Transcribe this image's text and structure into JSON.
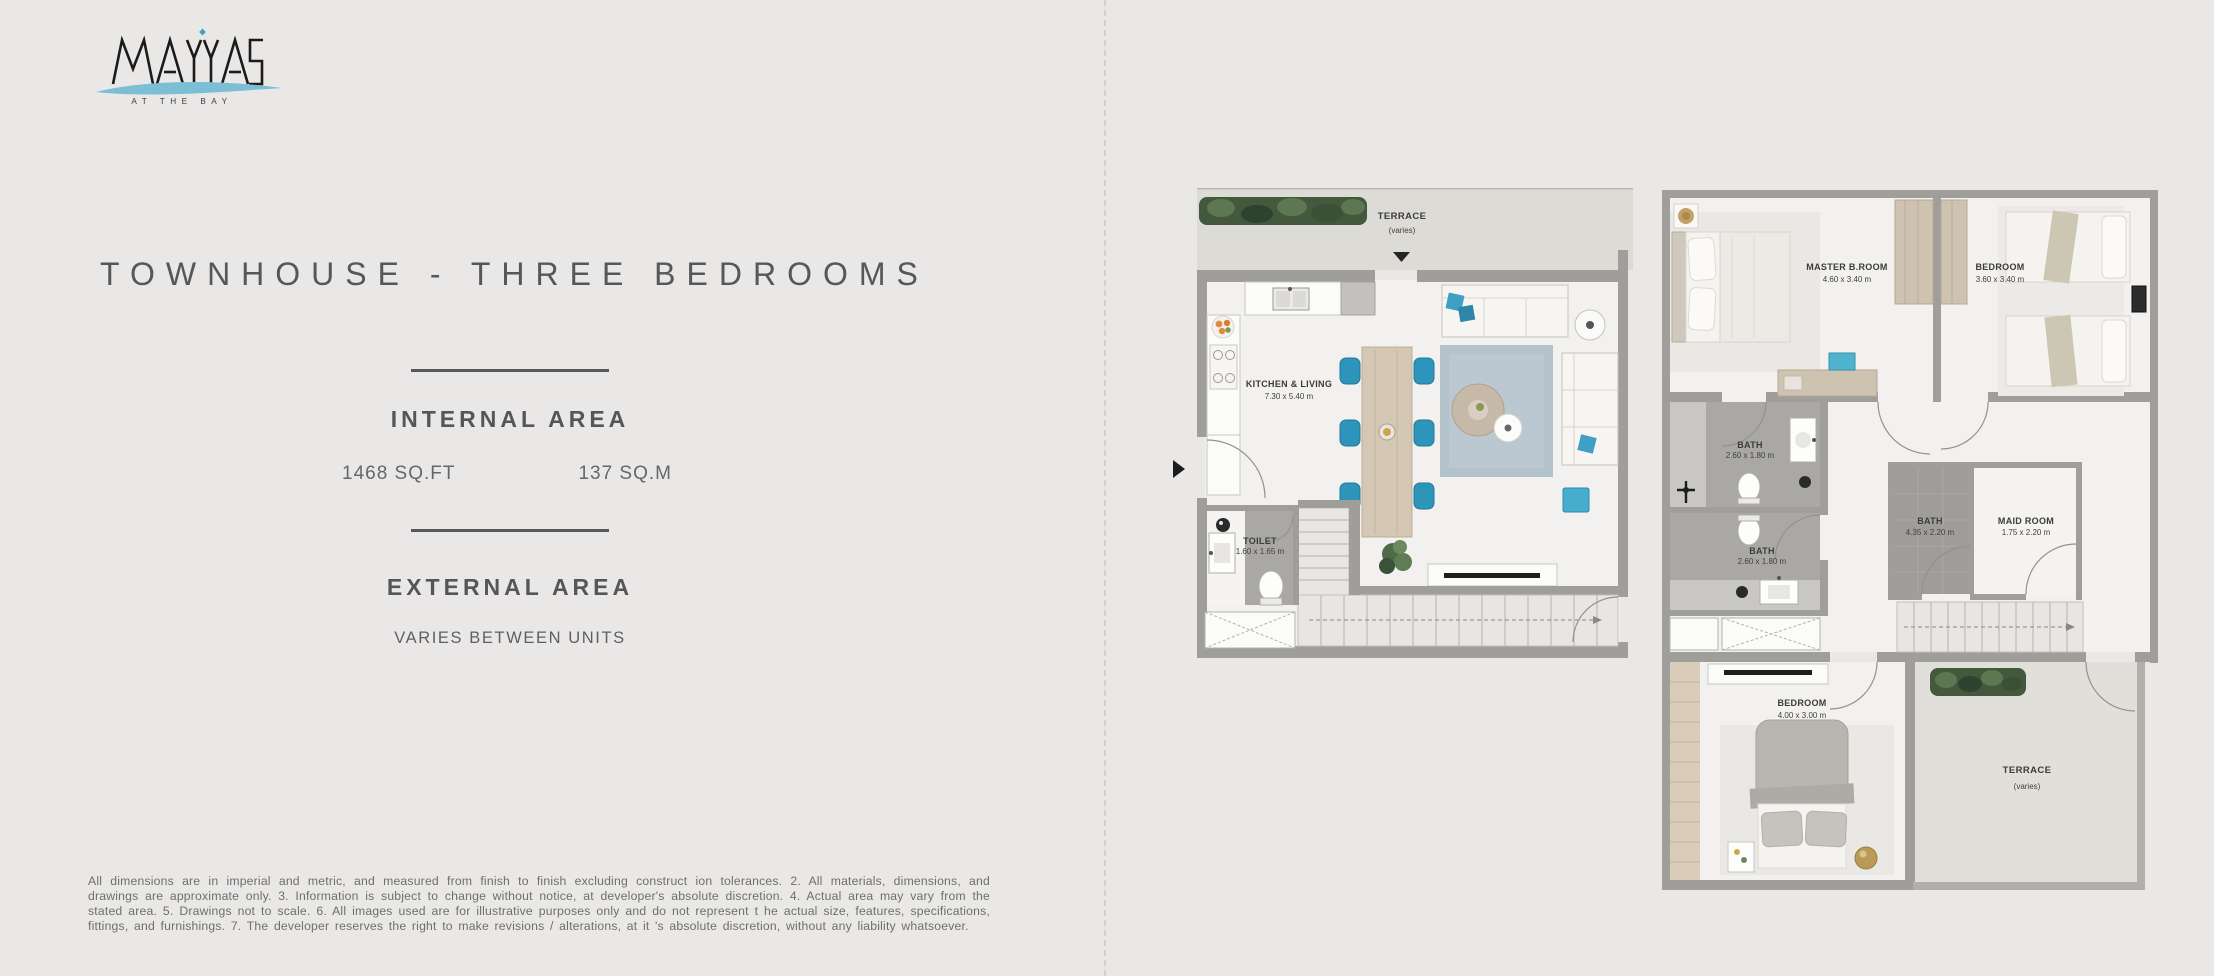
{
  "brand": {
    "name": "MAYAS",
    "tagline": "AT THE BAY"
  },
  "title": "TOWNHOUSE - THREE BEDROOMS",
  "internal": {
    "heading": "INTERNAL AREA",
    "imperial": "1468 SQ.FT",
    "metric": "137 SQ.M"
  },
  "external": {
    "heading": "EXTERNAL AREA",
    "value": "VARIES BETWEEN UNITS"
  },
  "disclaimer": "All dimensions are in imperial and metric, and measured from finish to finish excluding construct ion tolerances. 2. All materials, dimensions, and drawings are approximate only. 3. Information is subject to change without notice, at developer's absolute discretion. 4. Actual area may vary from the stated area. 5. Drawings not to scale. 6. All images used are for illustrative purposes only and do not represent t he actual size, features, specifications, fittings, and furnishings. 7. The developer reserves the right to make revisions / alterations, at it 's absolute discretion, without any liability whatsoever.",
  "ground_floor": {
    "terrace_label": "TERRACE",
    "terrace_sub": "(varies)",
    "kitchen_label": "KITCHEN & LIVING",
    "kitchen_dims": "7.30 x 5.40 m",
    "toilet_label": "TOILET",
    "toilet_dims": "1.60 x 1.65 m"
  },
  "first_floor": {
    "master_label": "MASTER B.ROOM",
    "master_dims": "4.60 x 3.40 m",
    "bedroom2_label": "BEDROOM",
    "bedroom2_dims": "3.60 x 3.40 m",
    "bath1_label": "BATH",
    "bath1_dims": "2.60 x 1.80 m",
    "bath2_label": "BATH",
    "bath2_dims": "2.60 x 1.80 m",
    "bath3_label": "BATH",
    "bath3_dims": "4.35 x 2.20 m",
    "maid_label": "MAID ROOM",
    "maid_dims": "1.75 x 2.20 m",
    "bedroom3_label": "BEDROOM",
    "bedroom3_dims": "4.00 x 3.00 m",
    "terrace_label": "TERRACE",
    "terrace_sub": "(varies)"
  },
  "colors": {
    "accent_teal": "#2f97ba",
    "swoosh_blue": "#7cbed5",
    "heading_gray": "#56575b",
    "wall_gray": "#9f9e9b",
    "page_bg": "#e9e8e6"
  }
}
